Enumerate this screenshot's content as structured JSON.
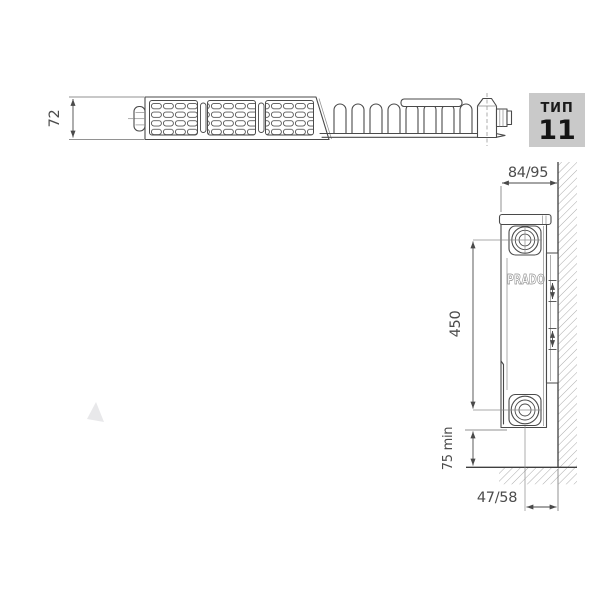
{
  "type_badge": {
    "label": "ТИП",
    "number": "11"
  },
  "brand": "PRADO",
  "dimensions": {
    "depth": "72",
    "wall_clearance": "84/95",
    "axis_spacing": "450",
    "floor_clearance": "75 min",
    "pipe_to_wall": "47/58"
  },
  "colors": {
    "line": "#4a4a4a",
    "hatch": "#a3a3a3",
    "badge_background": "#c9c9c9",
    "badge_text": "#1a1a1a",
    "brand_outline": "#8f8f8f",
    "watermark": "#e8e8ea"
  }
}
